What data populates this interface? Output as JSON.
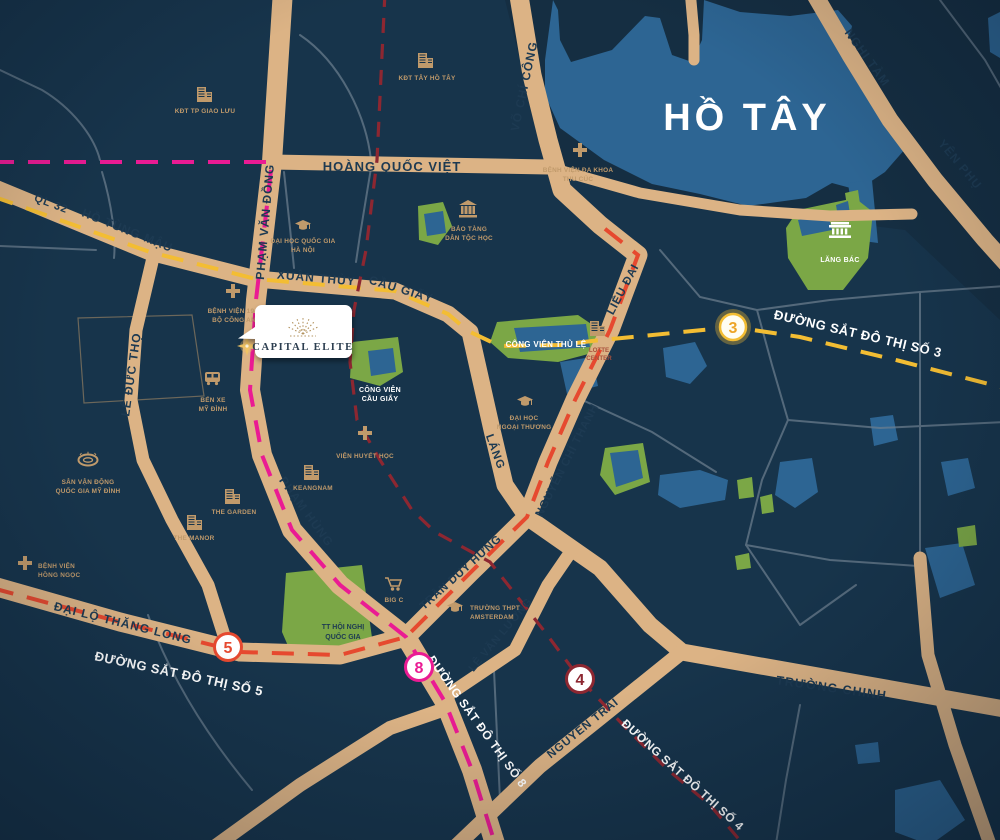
{
  "map": {
    "lake_title": "HỒ TÂY",
    "project": {
      "name": "CAPITAL ELITE"
    },
    "roads": {
      "hoang_quoc_viet": "HOÀNG QUỐC VIỆT",
      "pham_van_dong": "PHẠM VĂN ĐỒNG",
      "ql32": "QL 32",
      "ho_tung_mau": "HỒ TÙNG MẬU",
      "xuan_thuy": "XUÂN THỦY",
      "cau_giay": "CẦU GIẤY",
      "vo_chi_cong": "VÕ CHÍ CÔNG",
      "nghi_tam": "NGHI TÀM",
      "yen_phu": "YÊN PHỤ",
      "le_duc_tho": "LÊ ĐỨC THỌ",
      "pham_hung": "PHẠM HÙNG",
      "lang": "LÁNG",
      "nguyen_chi_thanh": "NGUYỄN CHÍ THANH",
      "lieu_giai": "LIỄU ĐAI",
      "tran_duy_hung": "TRẦN DUY HƯNG",
      "dai_lo_thang_long": "ĐẠI LỘ THĂNG LONG",
      "le_van_luong": "LÊ VĂN LƯƠNG",
      "nguyen_trai": "NGUYỄN TRÃI",
      "truong_chinh": "TRƯỜNG CHINH"
    },
    "metro": {
      "line3": {
        "badge": "3",
        "label": "ĐƯỜNG SẮT ĐÔ THỊ SỐ 3",
        "color": "#f3bd33"
      },
      "line5": {
        "badge": "5",
        "label": "ĐƯỜNG SẮT ĐÔ THỊ SỐ 5",
        "color": "#e6492f"
      },
      "line8": {
        "badge": "8",
        "label": "ĐƯỜNG SẮT ĐÔ THỊ SỐ 8",
        "color": "#ea1b93"
      },
      "line4": {
        "badge": "4",
        "label": "ĐƯỜNG SẮT ĐÔ THỊ SỐ 4",
        "color": "#8d2731"
      }
    },
    "pois": {
      "kdt_giao_luu": {
        "line1": "KĐT TP GIAO LƯU"
      },
      "kdt_tay_ho_tay": {
        "line1": "KĐT TÂY HỒ TÂY"
      },
      "bv_thu_cuc": {
        "line1": "BỆNH VIỆN ĐA KHOA",
        "line2": "THU CÚC"
      },
      "dhqg": {
        "line1": "ĐẠI HỌC QUỐC GIA",
        "line2": "HÀ NỘI"
      },
      "bao_tang": {
        "line1": "BẢO TÀNG",
        "line2": "DÂN TỘC HỌC"
      },
      "bv_198": {
        "line1": "BỆNH VIỆN 19-8",
        "line2": "BỘ CÔNG AN"
      },
      "ben_xe": {
        "line1": "BẾN XE",
        "line2": "MỸ ĐÌNH"
      },
      "lang_bac": {
        "line1": "LĂNG BÁC"
      },
      "lotte": {
        "line1": "LOTTE",
        "line2": "CENTER"
      },
      "cv_thu_le": {
        "line1": "CÔNG VIÊN THỦ LỆ"
      },
      "cv_cau_giay": {
        "line1": "CÔNG VIÊN",
        "line2": "CẦU GIẤY"
      },
      "dh_ngoai_thuong": {
        "line1": "ĐẠI HỌC",
        "line2": "NGOẠI THƯƠNG"
      },
      "vien_huyet_hoc": {
        "line1": "VIỆN HUYẾT HỌC"
      },
      "keangnam": {
        "line1": "KEANGNAM"
      },
      "the_garden": {
        "line1": "THE GARDEN"
      },
      "the_manor": {
        "line1": "THE MANOR"
      },
      "svd": {
        "line1": "SÂN VẬN ĐỘNG",
        "line2": "QUỐC GIA MỸ ĐÌNH"
      },
      "bv_hong_ngoc": {
        "line1": "BỆNH VIỆN",
        "line2": "HỒNG NGỌC"
      },
      "tt_hoi_nghi": {
        "line1": "TT HỘI NGHỊ",
        "line2": "QUỐC GIA"
      },
      "big_c": {
        "line1": "BIG C"
      },
      "ams": {
        "line1": "TRƯỜNG THPT",
        "line2": "AMSTERDAM"
      }
    },
    "colors": {
      "background": "#17344b",
      "water": "#2d6593",
      "road": "#dcb385",
      "park": "#7ba746",
      "road_text": "#1d3a52",
      "poi_text": "#c09a6b",
      "metro3": "#f3bd33",
      "metro5": "#e6492f",
      "metro8": "#ea1b93",
      "metro4": "#8d2731",
      "gold": "#b3935f"
    }
  }
}
